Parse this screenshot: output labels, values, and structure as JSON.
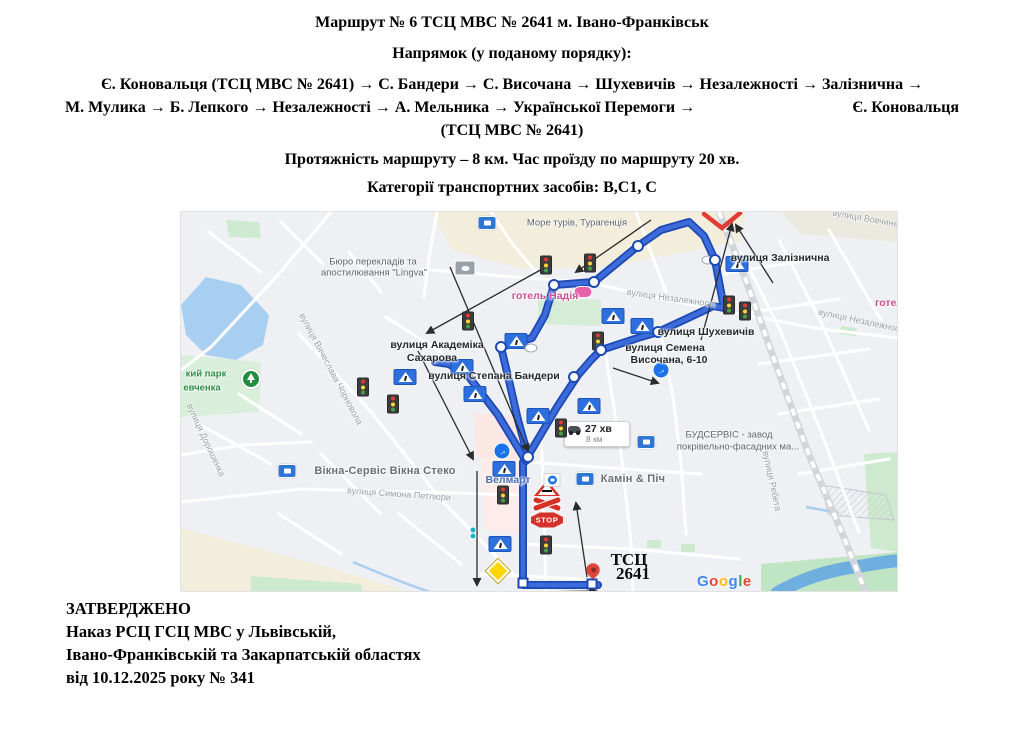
{
  "header": {
    "title": "Маршрут № 6 ТСЦ МВС № 2641 м. Івано-Франківськ",
    "direction_label": "Напрямок (у поданому порядку):",
    "route_line1": "Є. Коновальця (ТСЦ МВС № 2641) → С. Бандери → С. Височана → Шухевичів → Незалежності → Залізнична →",
    "route_line2_left": "М. Мулика → Б. Лепкого → Незалежності → А. Мельника → Української Перемоги →",
    "route_line2_right": "Є. Коновальця",
    "route_line3": "(ТСЦ МВС № 2641)",
    "length_line": "Протяжність маршруту – 8 км. Час проїзду по маршруту 20 хв.",
    "categories_line": "Категорії транспортних засобів: В,С1, С"
  },
  "approval": {
    "line1": "ЗАТВЕРДЖЕНО",
    "line2": "Наказ РСЦ ГСЦ МВС у Львівській,",
    "line3": "Івано-Франківській та Закарпатській областях",
    "line4": "від 10.12.2025 року № 341"
  },
  "colors": {
    "route_casing": "#1c49b4",
    "route_fill": "#3d6bd9",
    "water": "#a8cef2",
    "river": "#6fafe0",
    "street": "#ffffff",
    "railway": "#d2d5d9",
    "arrow": "#2b2b2b",
    "red_sign": "#d63128"
  },
  "map": {
    "info_box": {
      "time": "27 хв",
      "dist": "8 км"
    },
    "google_logo": {
      "letters": [
        "G",
        "o",
        "o",
        "g",
        "l",
        "e"
      ],
      "colors": [
        "#4285F4",
        "#EA4335",
        "#FBBC05",
        "#4285F4",
        "#34A853",
        "#EA4335"
      ]
    },
    "route_main": "417,373 342,373 342,250 347,244 376,195 397,163 410,148 420,138 460,125 477,120 520,100 532,94 543,96 534,48 523,24 508,10 480,18 457,34 413,70 373,73 364,103 351,126 320,135 329,173 337,208 347,244",
    "route_spur": "345,249 317,203 288,165 268,152 254,150",
    "railway": "538,0 565,68 595,153 628,243 662,323 685,381",
    "red_v": "523,2 541,16 559,1",
    "lake": "25,65 60,73 88,103 82,133 55,148 25,143 5,123 0,93",
    "river_path": "M596,381 C625,364 655,357 680,354 C698,351 714,348 722,349",
    "stream_paths": [
      "M172,350 C200,362 225,372 252,381",
      "M625,295 L658,301"
    ],
    "hatch_poly": "640,273 705,283 713,308 648,303",
    "areas": [
      {
        "f": "#f3eddc",
        "p": "250,0 565,0 558,30 420,56 338,56 272,38"
      },
      {
        "f": "#f3eddc",
        "p": "0,316 150,356 232,381 0,381"
      },
      {
        "f": "#eceadf",
        "p": "600,0 718,0 718,30 620,22"
      },
      {
        "f": "#ceead0",
        "p": "45,8 78,10 80,26 48,25"
      },
      {
        "f": "#d5ecd6",
        "p": "357,86 420,88 420,114 357,112"
      },
      {
        "f": "#d9eedb",
        "p": "0,143 80,150 78,200 0,205"
      },
      {
        "f": "#cdeacf",
        "p": "70,364 180,372 182,381 70,381"
      },
      {
        "f": "#cdeacf",
        "p": "683,242 718,240 718,340 690,336"
      },
      {
        "f": "#bfe5c4",
        "p": "580,352 718,340 718,381 580,381"
      },
      {
        "f": "#fbe7e4",
        "p": "292,201 340,204 342,248 296,246"
      },
      {
        "f": "#fdecea",
        "p": "300,246 345,248 347,321 303,318"
      },
      {
        "f": "#cdeacf",
        "p": "466,328 480,328 480,336 466,336"
      },
      {
        "f": "#cdeacf",
        "p": "500,332 514,332 514,340 500,340"
      },
      {
        "f": "#cdeacf",
        "p": "660,114 676,116 675,124 659,122"
      }
    ],
    "streets": [
      "150,0 95,65 30,135 0,158",
      "118,122 190,200 262,290 342,372",
      "0,290 120,277 275,281 342,283",
      "0,243 60,233 130,230",
      "360,215 363,300 365,381",
      "240,57 320,64 413,71",
      "256,0 248,45 243,85",
      "415,72 520,95 640,117 726,127",
      "560,40 600,120 640,220 678,320",
      "598,28 640,110 688,218",
      "648,18 700,108",
      "538,62 636,47",
      "558,102 658,87",
      "578,152 688,137",
      "598,202 698,187",
      "618,262 708,247",
      "28,20 80,60",
      "100,10 142,52",
      "168,40 200,80",
      "58,182 120,222",
      "18,212 90,252",
      "140,242 200,302",
      "218,302 280,352",
      "98,302 160,342",
      "347,250 430,256 520,262",
      "425,145 440,240 450,330 452,381",
      "480,122 492,185 500,250 505,322",
      "342,332 450,337 558,347",
      "300,362 400,367",
      "205,105 260,140",
      "455,0 470,40 485,80",
      "310,0 330,30 355,60"
    ],
    "arrows": [
      [
        470,
        8,
        395,
        60
      ],
      [
        363,
        56,
        246,
        121
      ],
      [
        269,
        55,
        347,
        239
      ],
      [
        237,
        139,
        292,
        247
      ],
      [
        296,
        259,
        296,
        373
      ],
      [
        406,
        365,
        395,
        291
      ],
      [
        432,
        156,
        477,
        171
      ],
      [
        520,
        128,
        551,
        12
      ],
      [
        592,
        71,
        555,
        13
      ],
      [
        352,
        380,
        415,
        379
      ]
    ],
    "labels": [
      {
        "t": "Море турів, Турагенція",
        "x": 396,
        "y": 11,
        "c": "poi"
      },
      {
        "t": "Бюро перекладів та",
        "x": 192,
        "y": 50,
        "c": "poi"
      },
      {
        "t": "апостилювання \"Lingva\"",
        "x": 193,
        "y": 61,
        "c": "poi"
      },
      {
        "t": "готель Надія",
        "x": 364,
        "y": 84,
        "c": "hotel"
      },
      {
        "t": "готел",
        "x": 708,
        "y": 91,
        "c": "hotel"
      },
      {
        "t": "вулиця Незалежності",
        "x": 490,
        "y": 86,
        "c": "street-rot",
        "r": 8
      },
      {
        "t": "вулиця Незалежності",
        "x": 681,
        "y": 109,
        "c": "street-rot",
        "r": 12
      },
      {
        "t": "вулиця Вовчинецька",
        "x": 694,
        "y": 8,
        "c": "street-rot",
        "r": 10
      },
      {
        "t": "вулиця Залізнична",
        "x": 599,
        "y": 46,
        "c": "street-bold"
      },
      {
        "t": "вулиця Шухевичів",
        "x": 525,
        "y": 120,
        "c": "street-bold"
      },
      {
        "t": "вулиця Семена",
        "x": 484,
        "y": 136,
        "c": "street-bold"
      },
      {
        "t": "Височана, 6-10",
        "x": 488,
        "y": 148,
        "c": "street-bold"
      },
      {
        "t": "вулиця Академіка",
        "x": 256,
        "y": 133,
        "c": "street-bold"
      },
      {
        "t": "Сахарова",
        "x": 251,
        "y": 146,
        "c": "street-bold"
      },
      {
        "t": "вулиця Степана Бандери",
        "x": 313,
        "y": 164,
        "c": "street-bold"
      },
      {
        "t": "вулиця Вячеслава Чорновола",
        "x": 150,
        "y": 157,
        "c": "street-rot",
        "r": 62
      },
      {
        "t": "вулиця Дорошенка",
        "x": 25,
        "y": 228,
        "c": "street-rot",
        "r": 65
      },
      {
        "t": "кий парк",
        "x": 25,
        "y": 162,
        "c": "park"
      },
      {
        "t": "евченка",
        "x": 21,
        "y": 176,
        "c": "park"
      },
      {
        "t": "Вікна-Сервіс Вікна Стеко",
        "x": 204,
        "y": 259,
        "c": "poi-lg"
      },
      {
        "t": "вулиця Симона Петлюри",
        "x": 218,
        "y": 282,
        "c": "street-rot",
        "r": 4
      },
      {
        "t": "Велмарт",
        "x": 327,
        "y": 268,
        "c": "store-blue"
      },
      {
        "t": "Камін & Піч",
        "x": 452,
        "y": 267,
        "c": "poi-lg"
      },
      {
        "t": "БУДСЕРВІС - завод",
        "x": 548,
        "y": 223,
        "c": "poi"
      },
      {
        "t": "покрівельно-фасадних ма...",
        "x": 557,
        "y": 235,
        "c": "poi"
      },
      {
        "t": "вулиця Ребета",
        "x": 591,
        "y": 269,
        "c": "street-rot",
        "r": 78
      },
      {
        "t": "ТСЦ",
        "x": 448,
        "y": 348,
        "c": "tsc"
      },
      {
        "t": "2641",
        "x": 452,
        "y": 362,
        "c": "tsc"
      }
    ],
    "icons": [
      {
        "t": "tl",
        "x": 365,
        "y": 53
      },
      {
        "t": "tl",
        "x": 409,
        "y": 51
      },
      {
        "t": "tl",
        "x": 287,
        "y": 109
      },
      {
        "t": "tl",
        "x": 182,
        "y": 175
      },
      {
        "t": "tl",
        "x": 212,
        "y": 192
      },
      {
        "t": "tl",
        "x": 380,
        "y": 216
      },
      {
        "t": "tl",
        "x": 417,
        "y": 129
      },
      {
        "t": "tl",
        "x": 548,
        "y": 93
      },
      {
        "t": "tl",
        "x": 564,
        "y": 99
      },
      {
        "t": "tl",
        "x": 365,
        "y": 333
      },
      {
        "t": "tl",
        "x": 322,
        "y": 283
      },
      {
        "t": "cw",
        "x": 335,
        "y": 129
      },
      {
        "t": "cw",
        "x": 281,
        "y": 155
      },
      {
        "t": "cw",
        "x": 294,
        "y": 182
      },
      {
        "t": "cw",
        "x": 224,
        "y": 165
      },
      {
        "t": "cw",
        "x": 357,
        "y": 204
      },
      {
        "t": "cw",
        "x": 408,
        "y": 194
      },
      {
        "t": "cw",
        "x": 432,
        "y": 104
      },
      {
        "t": "cw",
        "x": 556,
        "y": 52
      },
      {
        "t": "cw",
        "x": 323,
        "y": 257
      },
      {
        "t": "cw",
        "x": 319,
        "y": 332
      },
      {
        "t": "cw",
        "x": 461,
        "y": 114
      },
      {
        "t": "bc",
        "x": 480,
        "y": 158
      },
      {
        "t": "bc",
        "x": 321,
        "y": 239
      },
      {
        "t": "rwt",
        "x": 366,
        "y": 276
      },
      {
        "t": "xs",
        "x": 366,
        "y": 292
      },
      {
        "t": "stop",
        "x": 366,
        "y": 308
      },
      {
        "t": "dia",
        "x": 317,
        "y": 359
      },
      {
        "t": "pin",
        "x": 412,
        "y": 358
      },
      {
        "t": "pill",
        "x": 402,
        "y": 80
      },
      {
        "t": "poib",
        "x": 306,
        "y": 11
      },
      {
        "t": "poib",
        "x": 106,
        "y": 259
      },
      {
        "t": "poib",
        "x": 404,
        "y": 267
      },
      {
        "t": "poib",
        "x": 465,
        "y": 230
      },
      {
        "t": "poig",
        "x": 284,
        "y": 56
      },
      {
        "t": "park",
        "x": 70,
        "y": 167
      },
      {
        "t": "velm",
        "x": 371,
        "y": 268
      },
      {
        "t": "teal",
        "x": 292,
        "y": 318
      },
      {
        "t": "teal",
        "x": 292,
        "y": 324
      },
      {
        "t": "woval",
        "x": 527,
        "y": 48
      },
      {
        "t": "woval",
        "x": 350,
        "y": 136
      },
      {
        "t": "node",
        "x": 420,
        "y": 138
      },
      {
        "t": "node",
        "x": 477,
        "y": 120
      },
      {
        "t": "node",
        "x": 534,
        "y": 48
      },
      {
        "t": "node",
        "x": 457,
        "y": 34
      },
      {
        "t": "node",
        "x": 413,
        "y": 70
      },
      {
        "t": "node",
        "x": 373,
        "y": 73
      },
      {
        "t": "node",
        "x": 320,
        "y": 135
      },
      {
        "t": "node",
        "x": 347,
        "y": 245
      },
      {
        "t": "node",
        "x": 393,
        "y": 165
      },
      {
        "t": "sq",
        "x": 342,
        "y": 371
      },
      {
        "t": "sq",
        "x": 411,
        "y": 372
      }
    ]
  }
}
